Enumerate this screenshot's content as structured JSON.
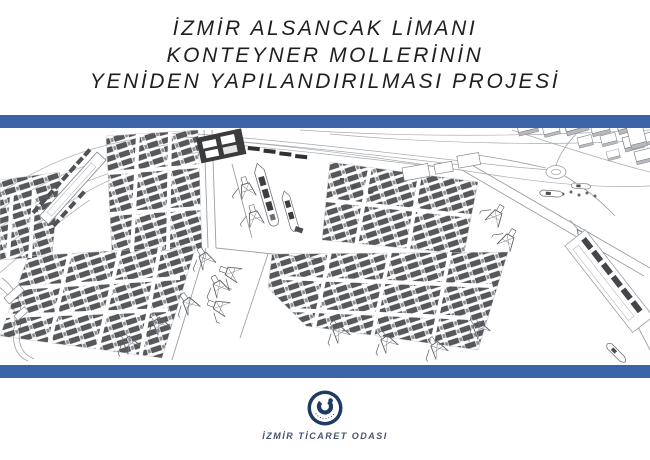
{
  "title": {
    "line1": "İZMİR ALSANCAK LİMANI",
    "line2": "KONTEYNER MOLLERİNİN",
    "line3": "YENİDEN YAPILANDIRILMASI PROJESİ"
  },
  "illustration": {
    "name": "port-3d-wireframe-drawing"
  },
  "footer": {
    "org_name": "İZMİR TİCARET ODASI",
    "logo": "izmir-ticaret-odasi-emblem"
  },
  "colors": {
    "accent_bar": "#3a63a8",
    "logo_navy": "#1f3a63",
    "footer_text": "#44546f",
    "title_text": "#1f1f1f"
  }
}
